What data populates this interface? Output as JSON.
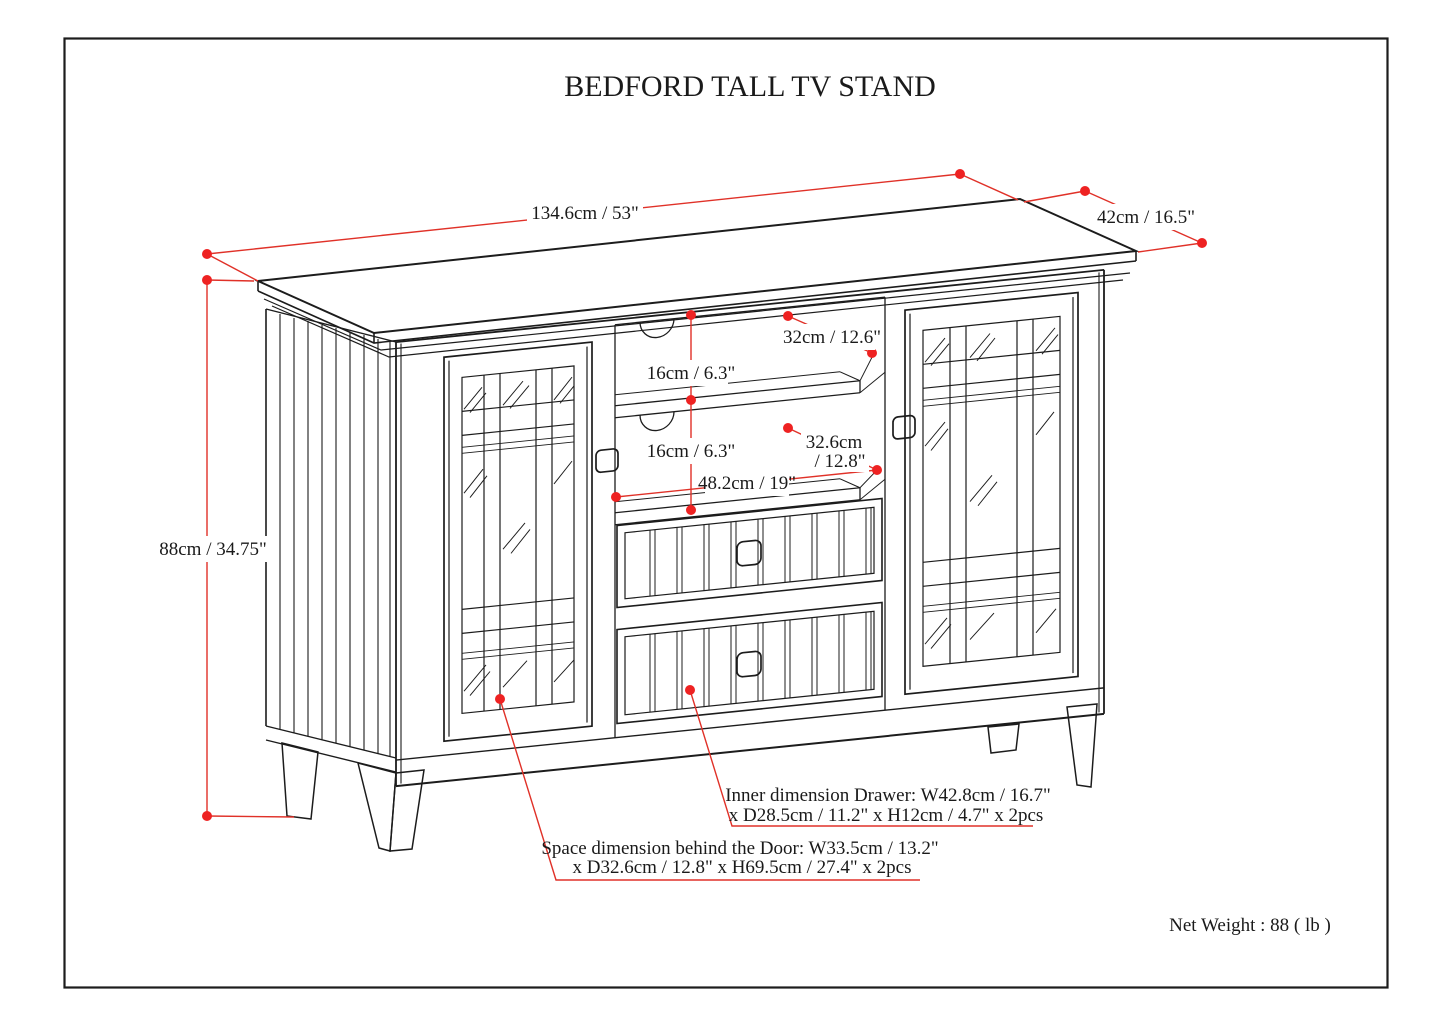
{
  "header": {
    "title": "BEDFORD TALL TV STAND"
  },
  "dimensions": {
    "overall_width": "134.6cm / 53\"",
    "overall_depth": "42cm / 16.5\"",
    "overall_height": "88cm / 34.75\"",
    "upper_shelf_gap": "16cm / 6.3\"",
    "lower_shelf_gap": "16cm / 6.3\"",
    "upper_shelf_depth": "32cm / 12.6\"",
    "lower_shelf_depth_line1": "32.6cm",
    "lower_shelf_depth_line2": "/ 12.8\"",
    "center_opening_width": "48.2cm / 19\""
  },
  "annotations": {
    "drawer_line1": "Inner dimension Drawer: W42.8cm / 16.7\"",
    "drawer_line2": "x D28.5cm / 11.2\" x H12cm / 4.7\" x 2pcs",
    "door_line1": "Space dimension behind the Door: W33.5cm / 13.2\"",
    "door_line2": "x D32.6cm / 12.8\" x H69.5cm / 27.4\" x 2pcs",
    "net_weight": "Net Weight : 88 ( lb )"
  },
  "colors": {
    "dimension_red": "#e8231f",
    "line_black": "#1c1c1c",
    "background": "#ffffff"
  }
}
